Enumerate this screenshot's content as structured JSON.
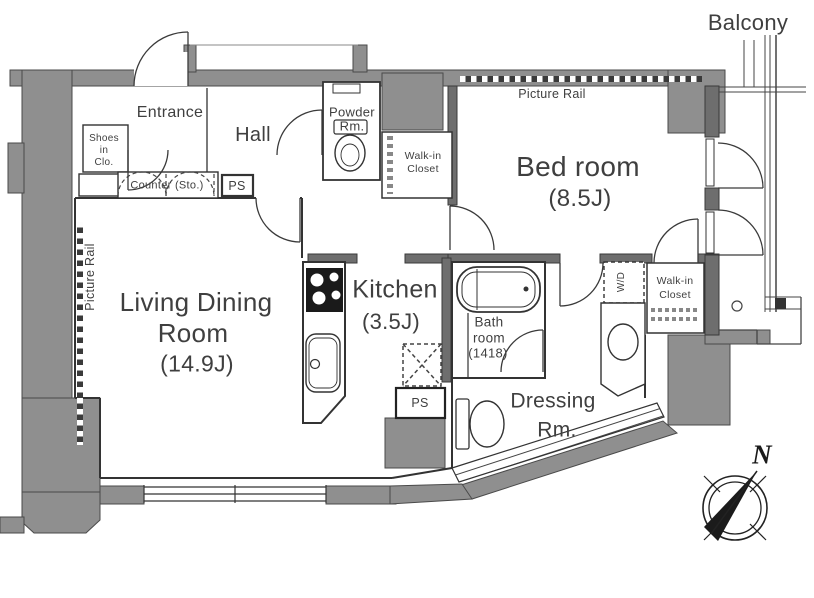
{
  "rooms": {
    "living": {
      "line1": "Living Dining",
      "line2": "Room",
      "size": "(14.9J)"
    },
    "bedroom": {
      "name": "Bed room",
      "size": "(8.5J)"
    },
    "kitchen": {
      "name": "Kitchen",
      "size": "(3.5J)"
    },
    "bath": {
      "line1": "Bath",
      "line2": "room",
      "size": "(1418)"
    },
    "dressing": {
      "line1": "Dressing",
      "line2": "Rm."
    },
    "hall": {
      "name": "Hall"
    },
    "entrance": {
      "name": "Entrance"
    },
    "powder": {
      "line1": "Powder",
      "line2": "Rm."
    },
    "balcony": {
      "name": "Balcony"
    },
    "walkin_top": {
      "line1": "Walk-in",
      "line2": "Closet"
    },
    "walkin_right": {
      "line1": "Walk-in",
      "line2": "Closet"
    },
    "shoes_closet": {
      "line1": "Shoes",
      "line2": "in",
      "line3": "Clo."
    },
    "counter": {
      "name": "Counter (Sto.)"
    },
    "wd": {
      "name": "W/D"
    },
    "ps_top": {
      "name": "PS"
    },
    "ps_bottom": {
      "name": "PS"
    }
  },
  "annotations": {
    "picture_rail_top": "Picture Rail",
    "picture_rail_left": "Picture Rail",
    "compass_north": "N"
  },
  "colors": {
    "wall_gray": "#8f8f8f",
    "wall_dark": "#6e6e6e",
    "line": "#333333",
    "text": "#3f3f3f"
  }
}
